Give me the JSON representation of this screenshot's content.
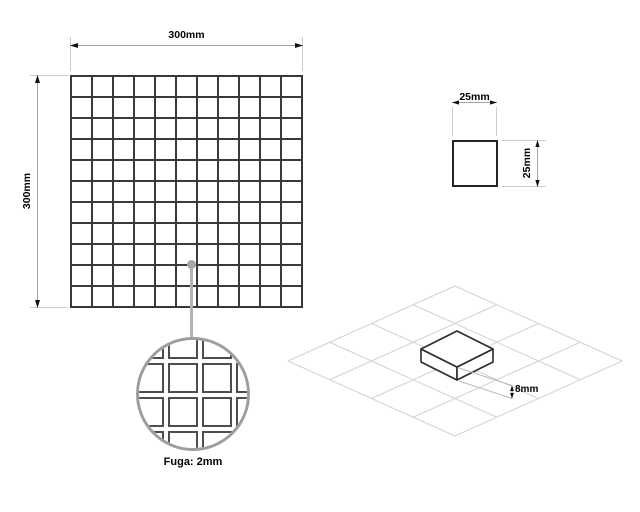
{
  "drawing": {
    "sheet": {
      "width_label": "300mm",
      "height_label": "300mm",
      "grid": {
        "rows": 11,
        "columns": 11
      }
    },
    "tile": {
      "width_label": "25mm",
      "height_label": "25mm"
    },
    "detail": {
      "caption": "Fuga: 2mm",
      "grid": {
        "rows": 4,
        "columns": 4
      }
    },
    "iso": {
      "thickness_label": "8mm",
      "grid": {
        "rows": 4,
        "columns": 4
      }
    },
    "colors": {
      "drawing_line": "#353535",
      "dimension_line": "#a3a3a3",
      "extension_line": "#cdcdcd",
      "detail_circle_stroke": "#9e9e9e",
      "iso_grid_line": "#d2d2d2",
      "text": "#000000",
      "background": "#ffffff"
    }
  }
}
